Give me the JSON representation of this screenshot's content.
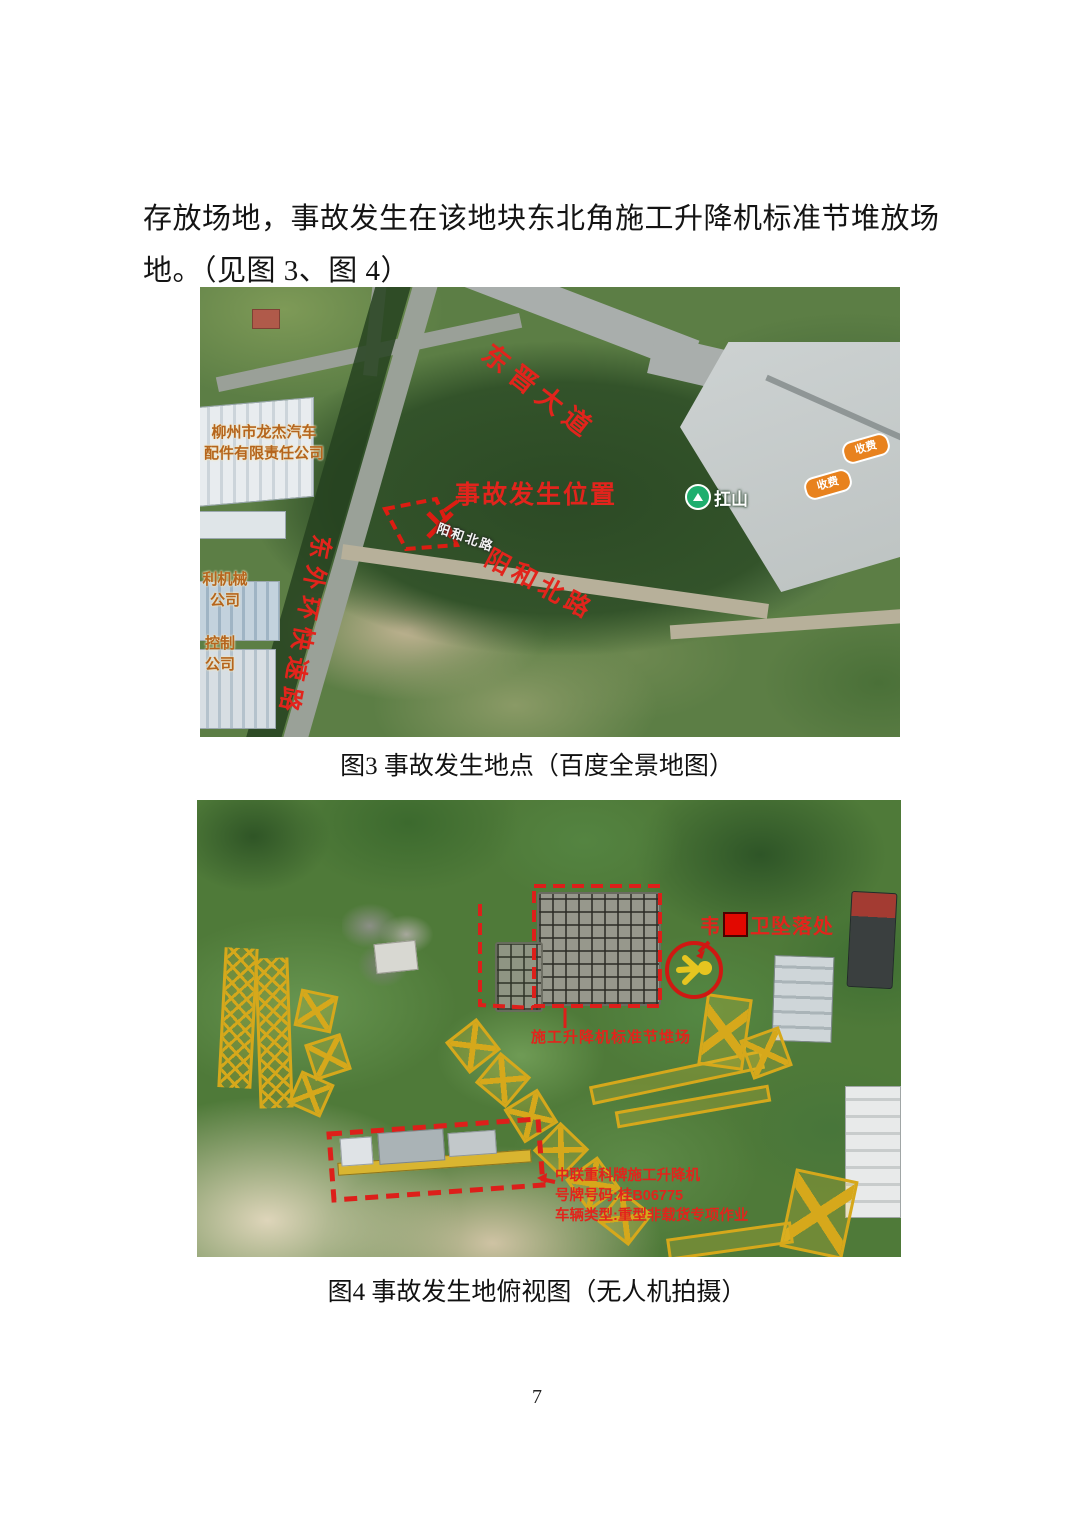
{
  "page": {
    "paragraph": {
      "line1": "存放场地，事故发生在该地块东北角施工升降机标准节堆放场",
      "line2": "地。（见图 3、图 4）"
    },
    "page_number": "7"
  },
  "figure3": {
    "caption": "图3 事故发生地点（百度全景地图）",
    "annotations": {
      "avenue": "东晋大道",
      "accident_position": "事故发生位置",
      "road_small_white": "阳和北路",
      "road_red": "阳和北路",
      "expressway": "东外环快速路",
      "company_main_l1": "柳州市龙杰汽车",
      "company_main_l2": "配件有限责任公司",
      "company_left1_l1": "利机械",
      "company_left1_l2": "公司",
      "company_left2_l1": "控制",
      "company_left2_l2": "公司",
      "mountain_label": "扛山",
      "toll_badge": "收费"
    }
  },
  "figure4": {
    "caption": "图4 事故发生地俯视图（无人机拍摄）",
    "annotations": {
      "fall_first": "韦",
      "fall_rest": "卫坠落处",
      "stack_label": "施工升降机标准节堆场",
      "hoist_line1": "中联重科牌施工升降机",
      "hoist_line2": "号牌号码:桂B06775",
      "hoist_line3": "车辆类型:重型非载货专项作业"
    }
  },
  "colors": {
    "annotation_red": "#e2241c",
    "toll_badge_orange": "#e8821e",
    "map_label_orange": "#b5651d",
    "mountain_pin_green": "#1fae6e",
    "mast_yellow": "#d6a81b"
  }
}
